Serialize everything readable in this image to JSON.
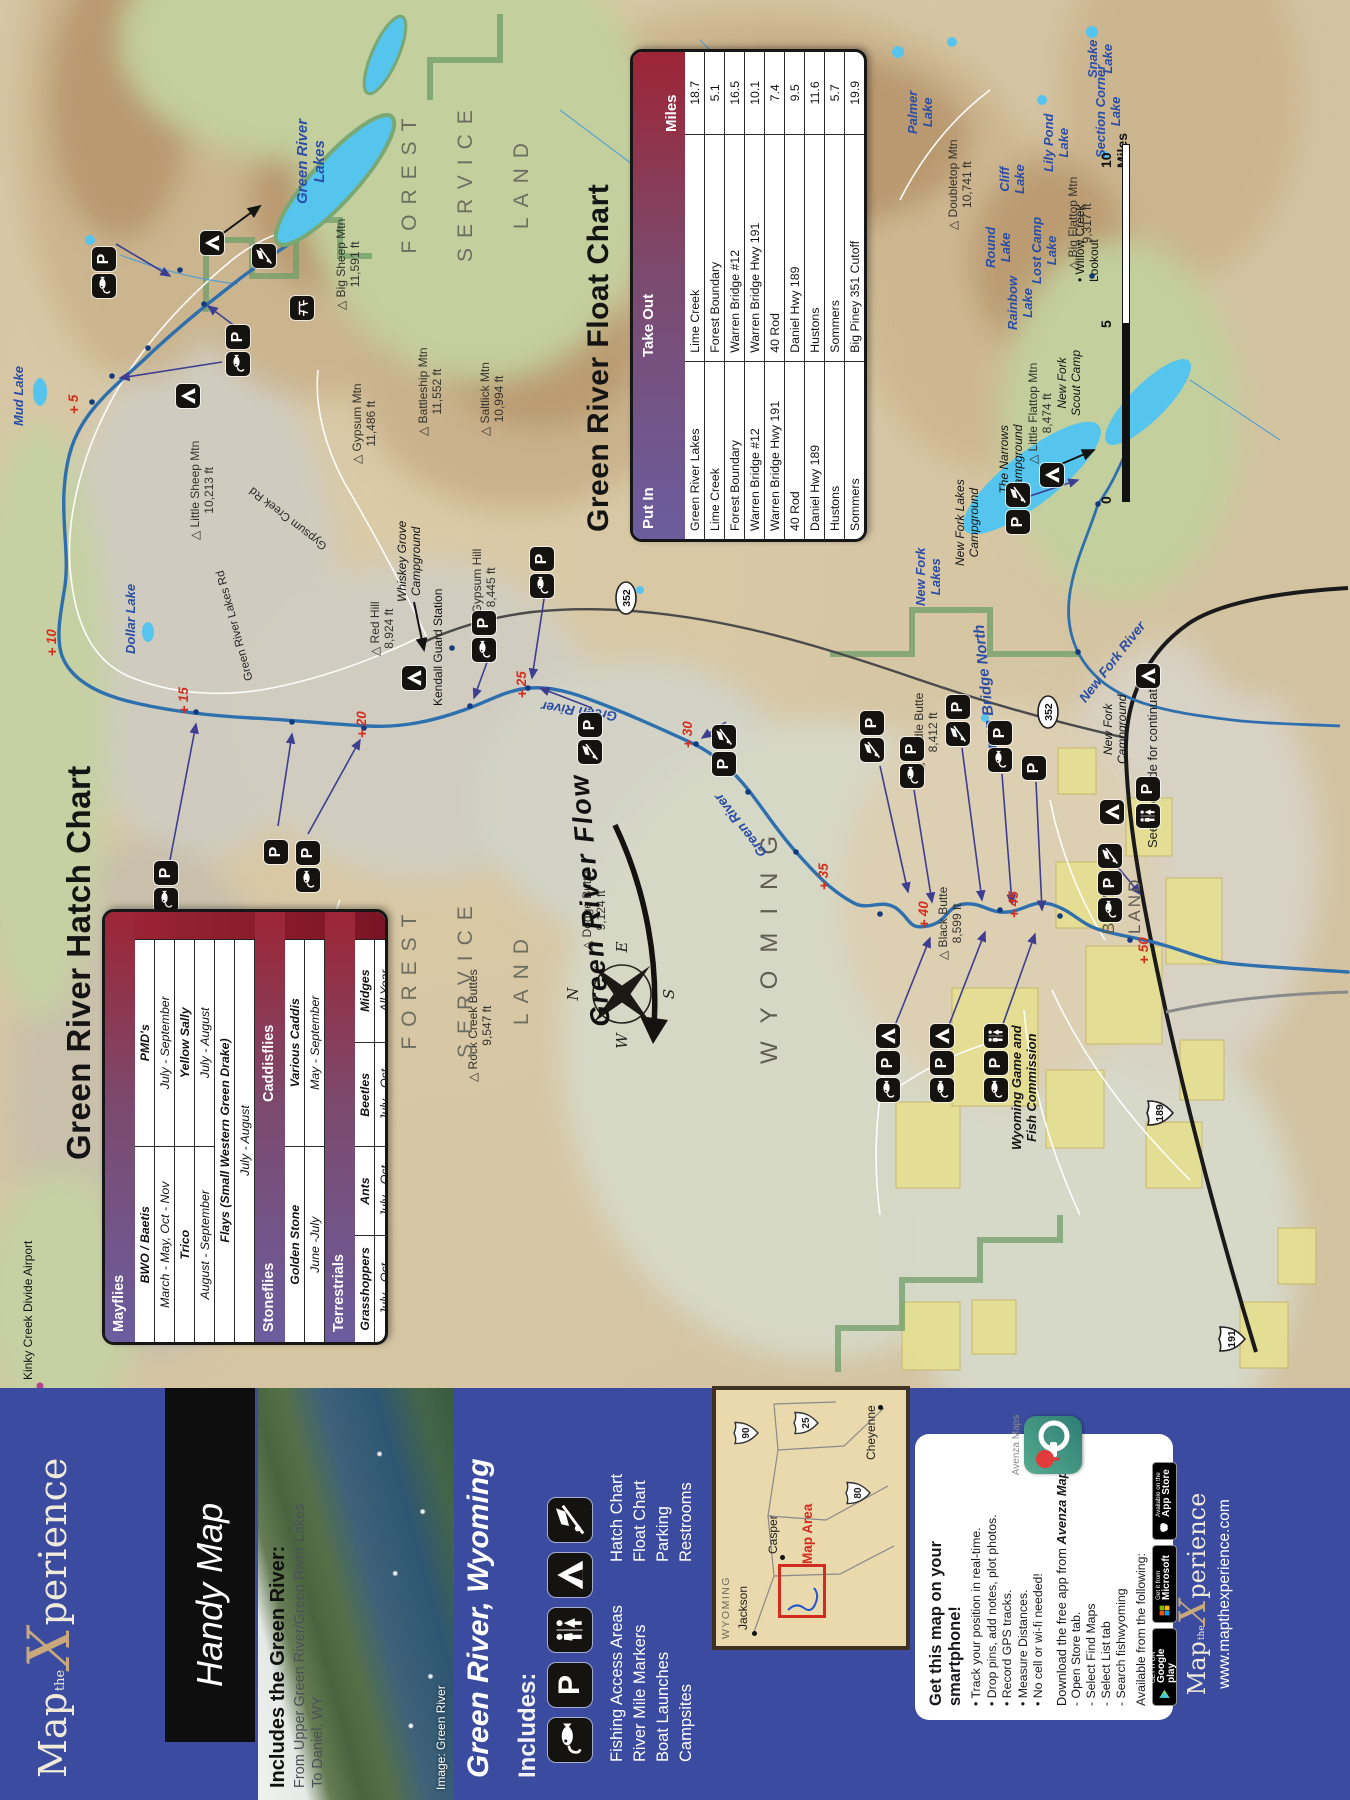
{
  "brand": {
    "logo_map": "Map",
    "logo_the": "the",
    "logo_x": "X",
    "logo_suffix": "perience",
    "handy": "Handy Map",
    "website": "www.mapthexperience.com"
  },
  "cover": {
    "region_title": "Green River, Wyoming",
    "includes_heading": "Includes the Green River:",
    "includes_sub1": "From Upper Green River/Green River Lakes",
    "includes_sub2": "To Daniel, WY",
    "photo_credit": "Image: Green River"
  },
  "legend": {
    "heading": "Includes:",
    "icons": [
      "fish",
      "park",
      "restroom",
      "camp",
      "boat"
    ],
    "items_left": [
      "Fishing Access Areas",
      "River Mile Markers",
      "Boat Launches",
      "Campsites"
    ],
    "items_right": [
      "Hatch Chart",
      "Float Chart",
      "Parking",
      "Restrooms"
    ]
  },
  "inset": {
    "state": "WYOMING",
    "map_area_label": "Map Area",
    "towns": [
      {
        "name": "Jackson"
      },
      {
        "name": "Casper"
      },
      {
        "name": "Cheyenne"
      }
    ],
    "shields": [
      "90",
      "25",
      "80"
    ]
  },
  "smartphone": {
    "title": "Get this map on your smartphone!",
    "bullets": [
      "Track your position in real-time.",
      "Drop pins, add notes, plot photos.",
      "Record GPS tracks.",
      "Measure Distances.",
      "No cell or wi-fi needed!"
    ],
    "download_line": "Download the free app from",
    "app_name": "Avenza Maps",
    "steps": [
      "- Open Store tab.",
      "- Select Find Maps",
      "- Select List tab",
      "- Search fishwyoming"
    ],
    "available": "Available from the following:",
    "badges": [
      {
        "top": "GET IT ON",
        "name": "Google play"
      },
      {
        "top": "Get it from",
        "name": "Microsoft"
      },
      {
        "top": "Available on the",
        "name": "App Store"
      }
    ],
    "logo_caption": "Avenza Maps"
  },
  "hatch_chart": {
    "title": "Green River Hatch Chart",
    "rows": [
      {
        "type": "band",
        "c1": "Mayflies"
      },
      {
        "type": "cols2",
        "bold": true,
        "cells": [
          "BWO / Baetis",
          "PMD's"
        ]
      },
      {
        "type": "cols2",
        "cells": [
          "March - May, Oct - Nov",
          "July - September"
        ]
      },
      {
        "type": "cols2",
        "bold": true,
        "cells": [
          "Trico",
          "Yellow Sally"
        ]
      },
      {
        "type": "cols2",
        "cells": [
          "August - September",
          "July - August"
        ]
      },
      {
        "type": "span",
        "bold": true,
        "cells": [
          "Flays (Small Western Green Drake)"
        ]
      },
      {
        "type": "span",
        "cells": [
          "July - August"
        ]
      },
      {
        "type": "band",
        "c1": "Stoneflies",
        "c2": "Caddisflies"
      },
      {
        "type": "cols2",
        "bold": true,
        "cells": [
          "Golden Stone",
          "Various Caddis"
        ]
      },
      {
        "type": "cols2",
        "cells": [
          "June -July",
          "May - September"
        ]
      },
      {
        "type": "band",
        "c1": "Terrestrials"
      },
      {
        "type": "cols4",
        "bold": true,
        "cells": [
          "Grasshoppers",
          "Ants",
          "Beetles",
          "Midges"
        ]
      },
      {
        "type": "cols4",
        "cells": [
          "July - Oct",
          "July - Oct",
          "July - Oct",
          "All Year"
        ]
      }
    ]
  },
  "float_chart": {
    "title": "Green River Float Chart",
    "columns": [
      "Put In",
      "Take Out",
      "Miles"
    ],
    "rows": [
      [
        "Green River Lakes",
        "Lime Creek",
        "18.7"
      ],
      [
        "Lime Creek",
        "Forest Boundary",
        "5.1"
      ],
      [
        "Forest Boundary",
        "Warren Bridge #12",
        "16.5"
      ],
      [
        "Warren Bridge #12",
        "Warren Bridge Hwy 191",
        "10.1"
      ],
      [
        "Warren Bridge Hwy 191",
        "40 Rod",
        "7.4"
      ],
      [
        "40 Rod",
        "Daniel Hwy 189",
        "9.5"
      ],
      [
        "Daniel Hwy 189",
        "Hustons",
        "11.6"
      ],
      [
        "Hustons",
        "Sommers",
        "5.7"
      ],
      [
        "Sommers",
        "Big Piney 351 Cutoff",
        "19.9"
      ]
    ]
  },
  "map": {
    "scale": {
      "zero": "0",
      "mid": "5",
      "end": "10 Miles"
    },
    "compass": {
      "n": "N",
      "e": "E",
      "s": "S",
      "w": "W"
    },
    "flow_label": "Green  River  Flow",
    "labels": [
      {
        "t": "Green River\nLakes",
        "x": 1596,
        "y": 294,
        "cls": "lake lg"
      },
      {
        "t": "Mud Lake",
        "x": 1374,
        "y": 12,
        "cls": "lake"
      },
      {
        "t": "Dollar Lake",
        "x": 1146,
        "y": 124,
        "cls": "lake"
      },
      {
        "t": "Palmer\nLake",
        "x": 1666,
        "y": 906,
        "cls": "lake"
      },
      {
        "t": "Round\nLake",
        "x": 1532,
        "y": 984,
        "cls": "lake"
      },
      {
        "t": "Lost Camp\nLake",
        "x": 1516,
        "y": 1030,
        "cls": "lake"
      },
      {
        "t": "Cliff\nLake",
        "x": 1606,
        "y": 998,
        "cls": "lake"
      },
      {
        "t": "Lily Pond\nLake",
        "x": 1628,
        "y": 1042,
        "cls": "lake"
      },
      {
        "t": "Section Corner\nLake",
        "x": 1642,
        "y": 1094,
        "cls": "lake"
      },
      {
        "t": "Snake\nLake",
        "x": 1722,
        "y": 1086,
        "cls": "lake"
      },
      {
        "t": "Rainbow\nLake",
        "x": 1470,
        "y": 1006,
        "cls": "lake"
      },
      {
        "t": "New Fork\nLakes",
        "x": 1194,
        "y": 914,
        "cls": "lake"
      },
      {
        "t": "△ Big Sheep Mtn\n11,591 ft",
        "x": 1490,
        "y": 334,
        "cls": "mtn"
      },
      {
        "t": "△ Saltlick Mtn\n10,994 ft",
        "x": 1364,
        "y": 478,
        "cls": "mtn"
      },
      {
        "t": "△ Gypsum Mtn\n11,486 ft",
        "x": 1336,
        "y": 350,
        "cls": "mtn"
      },
      {
        "t": "△ Battleship Mtn\n11,552 ft",
        "x": 1364,
        "y": 416,
        "cls": "mtn"
      },
      {
        "t": "△ Little Sheep Mtn\n10,213 ft",
        "x": 1260,
        "y": 188,
        "cls": "mtn"
      },
      {
        "t": "△ Doubletop Mtn\n10,741 ft",
        "x": 1570,
        "y": 946,
        "cls": "mtn"
      },
      {
        "t": "△ Big Flattop Mtn\n9,317 ft",
        "x": 1530,
        "y": 1066,
        "cls": "mtn"
      },
      {
        "t": "△ Little Flattop Mtn\n8,474 ft",
        "x": 1336,
        "y": 1026,
        "cls": "mtn"
      },
      {
        "t": "△ Middle Butte\n8,412 ft",
        "x": 1028,
        "y": 912,
        "cls": "mtn"
      },
      {
        "t": "△ Black Butte\n8,599 ft",
        "x": 840,
        "y": 936,
        "cls": "mtn"
      },
      {
        "t": "△ Dodge Butte\n9,124 ft",
        "x": 850,
        "y": 580,
        "cls": "mtn"
      },
      {
        "t": "△ Rock Creek Buttes\n9,547 ft",
        "x": 718,
        "y": 466,
        "cls": "mtn"
      },
      {
        "t": "△ Red Hill\n8,924 ft",
        "x": 1144,
        "y": 368,
        "cls": "mtn"
      },
      {
        "t": "△ Gypsum Hill\n8,445 ft",
        "x": 1174,
        "y": 470,
        "cls": "mtn"
      },
      {
        "t": "FOREST\nSERVICE\nLAND",
        "x": 1538,
        "y": 382,
        "cls": "area"
      },
      {
        "t": "FOREST\nSERVICE\nLAND",
        "x": 742,
        "y": 382,
        "cls": "area"
      },
      {
        "t": "WYOMING",
        "x": 736,
        "y": 756,
        "cls": "wyo"
      },
      {
        "t": "BLM\nLAND",
        "x": 866,
        "y": 1096,
        "cls": "blm"
      },
      {
        "t": "See other side for continuation",
        "x": 952,
        "y": 1146,
        "cls": "cont"
      },
      {
        "t": "The Narrows\nCampground",
        "x": 1306,
        "y": 998,
        "cls": "cg"
      },
      {
        "t": "New Fork Lakes\nCampground",
        "x": 1234,
        "y": 954,
        "cls": "cg"
      },
      {
        "t": "New Fork\nScout Camp",
        "x": 1384,
        "y": 1056,
        "cls": "cg"
      },
      {
        "t": "New Fork\nCampground",
        "x": 1036,
        "y": 1102,
        "cls": "cg"
      },
      {
        "t": "Whiskey Grove\nCampground",
        "x": 1198,
        "y": 396,
        "cls": "cg"
      },
      {
        "t": "Wyoming Game and\nFish Commission",
        "x": 650,
        "y": 1010,
        "cls": "cg gf"
      },
      {
        "t": "Kendall Guard Station",
        "x": 1094,
        "y": 432,
        "cls": "poi"
      },
      {
        "t": "• Willow Creek\nLookout",
        "x": 1518,
        "y": 1074,
        "cls": "poi"
      },
      {
        "t": "Kinky Creek Divide Airport",
        "x": 420,
        "y": 22,
        "cls": "poi"
      },
      {
        "t": "Green River Lakes Rd",
        "x": 1118,
        "y": 244,
        "cls": "rd",
        "rot": -15
      },
      {
        "t": "Gypsum Creek Rd",
        "x": 1248,
        "y": 322,
        "cls": "rd",
        "rot": -52
      },
      {
        "t": "Green River",
        "x": 1076,
        "y": 616,
        "cls": "rl",
        "rot": -82
      },
      {
        "t": "Green River",
        "x": 940,
        "y": 758,
        "cls": "rl",
        "rot": -38
      },
      {
        "t": "New Fork River",
        "x": 1104,
        "y": 1076,
        "cls": "rl",
        "rot": 38
      },
      {
        "t": "Warren Bridge North",
        "x": 1028,
        "y": 986,
        "cls": "wbn",
        "rot": -6
      },
      {
        "t": "Green  River  Flow",
        "x": 772,
        "y": 586,
        "cls": "flow",
        "rot": -5
      }
    ],
    "mile_markers": [
      {
        "n": "5",
        "x": 1392,
        "y": 74
      },
      {
        "n": "10",
        "x": 1150,
        "y": 52
      },
      {
        "n": "15",
        "x": 1092,
        "y": 184
      },
      {
        "n": "20",
        "x": 1068,
        "y": 362
      },
      {
        "n": "25",
        "x": 1108,
        "y": 522
      },
      {
        "n": "30",
        "x": 1058,
        "y": 688
      },
      {
        "n": "35",
        "x": 916,
        "y": 824
      },
      {
        "n": "40",
        "x": 878,
        "y": 924
      },
      {
        "n": "45",
        "x": 888,
        "y": 1014
      },
      {
        "n": "50",
        "x": 842,
        "y": 1144
      }
    ],
    "icons": [
      {
        "x": 1502,
        "y": 92,
        "k": [
          "fish",
          "park"
        ]
      },
      {
        "x": 1545,
        "y": 200,
        "k": [
          "camp"
        ]
      },
      {
        "x": 1392,
        "y": 176,
        "k": [
          "camp"
        ]
      },
      {
        "x": 1424,
        "y": 226,
        "k": [
          "fish",
          "park"
        ]
      },
      {
        "x": 1480,
        "y": 290,
        "k": [
          "picnic"
        ]
      },
      {
        "x": 1532,
        "y": 252,
        "k": [
          "boat"
        ]
      },
      {
        "x": 888,
        "y": 154,
        "k": [
          "fish",
          "park"
        ]
      },
      {
        "x": 936,
        "y": 264,
        "k": [
          "park"
        ]
      },
      {
        "x": 908,
        "y": 296,
        "k": [
          "fish",
          "park"
        ]
      },
      {
        "x": 1110,
        "y": 402,
        "k": [
          "camp"
        ]
      },
      {
        "x": 1138,
        "y": 472,
        "k": [
          "fish",
          "park"
        ]
      },
      {
        "x": 1202,
        "y": 530,
        "k": [
          "fish",
          "park"
        ]
      },
      {
        "x": 1036,
        "y": 578,
        "k": [
          "boat",
          "park"
        ]
      },
      {
        "x": 1024,
        "y": 712,
        "k": [
          "park",
          "boat"
        ]
      },
      {
        "x": 1038,
        "y": 860,
        "k": [
          "boat",
          "park"
        ]
      },
      {
        "x": 1012,
        "y": 900,
        "k": [
          "fish",
          "park"
        ]
      },
      {
        "x": 1054,
        "y": 946,
        "k": [
          "boat",
          "park"
        ]
      },
      {
        "x": 1028,
        "y": 988,
        "k": [
          "fish",
          "park"
        ]
      },
      {
        "x": 1020,
        "y": 1022,
        "k": [
          "park"
        ]
      },
      {
        "x": 1266,
        "y": 1006,
        "k": [
          "park",
          "boat"
        ]
      },
      {
        "x": 1313,
        "y": 1040,
        "k": [
          "camp"
        ]
      },
      {
        "x": 1112,
        "y": 1136,
        "k": [
          "camp"
        ]
      },
      {
        "x": 878,
        "y": 1098,
        "k": [
          "fish",
          "park",
          "boat"
        ]
      },
      {
        "x": 976,
        "y": 1100,
        "k": [
          "camp"
        ]
      },
      {
        "x": 972,
        "y": 1136,
        "k": [
          "restroom",
          "park"
        ]
      },
      {
        "x": 698,
        "y": 876,
        "k": [
          "fish",
          "park",
          "camp"
        ]
      },
      {
        "x": 698,
        "y": 930,
        "k": [
          "fish",
          "park",
          "camp"
        ]
      },
      {
        "x": 698,
        "y": 984,
        "k": [
          "fish",
          "park",
          "restroom"
        ]
      }
    ],
    "shields": [
      {
        "kind": "us",
        "n": "191",
        "x": 446,
        "y": 1216
      },
      {
        "kind": "us",
        "n": "189",
        "x": 672,
        "y": 1144
      },
      {
        "kind": "oval",
        "n": "352",
        "x": 1184,
        "y": 614
      },
      {
        "kind": "oval",
        "n": "352",
        "x": 1070,
        "y": 1036
      }
    ]
  }
}
